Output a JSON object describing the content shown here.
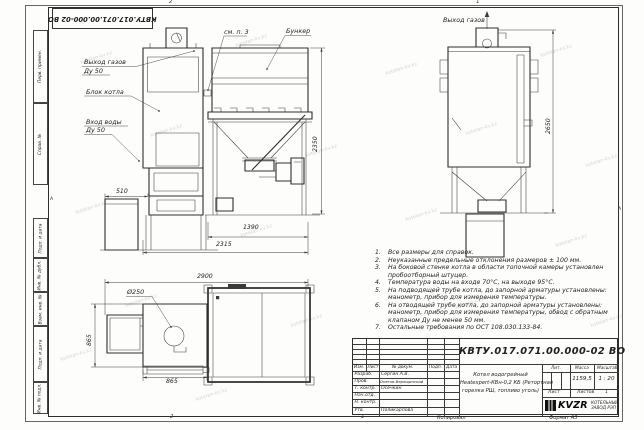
{
  "sheet": {
    "corner_ref": "КВТУ.017.071.00.000-02 ВО",
    "zones": {
      "top_left": "2",
      "top_right": "1",
      "bottom_left": "2",
      "bottom_right": "1"
    },
    "fold_mark": "А",
    "side_stamps": [
      "Перв. примен.",
      "Справ. №",
      "Подп. и дата",
      "Инв. № дубл.",
      "Взам. инв. №",
      "Подп. и дата",
      "Инв. № подл."
    ]
  },
  "watermark": {
    "text": "kotelan-kv.kz"
  },
  "callouts": {
    "gas_out_front_1": "Выход газов",
    "gas_out_front_2": "Ду 50",
    "boiler_block": "Блок котла",
    "water_in_1": "Вход воды",
    "water_in_2": "Ду 50",
    "see_note_3": "см. п. 3",
    "bunker": "Бункер",
    "gas_out_side": "Выход газов",
    "diameter": "Ø250"
  },
  "dimensions": {
    "ash_width": "510",
    "bunker_height": "2350",
    "bunker_width": "1390",
    "depth": "2315",
    "side_height": "2650",
    "plan_width": "2900",
    "plan_depth": "865",
    "boiler_width": "865"
  },
  "notes": {
    "items": [
      {
        "n": "1.",
        "text": "Все размеры для справок."
      },
      {
        "n": "2.",
        "text": "Неуказанные предельные отклонения размеров ± 100 мм."
      },
      {
        "n": "3.",
        "text": "На боковой стенке котла в области топочной камеры установлен пробоотборный штуцер."
      },
      {
        "n": "4.",
        "text": "Температура воды на входе 70°С, на выходе 95°С."
      },
      {
        "n": "5.",
        "text": "На подводящей трубе котла, до запорной арматуры установлены: манометр, прибор для измерения температуры."
      },
      {
        "n": "6.",
        "text": "На отводящей трубе котла, до запорной арматуры установлены: манометр, прибор для измерения температуры, обвод с обратным клапаном Ду не менее 50 мм."
      },
      {
        "n": "7.",
        "text": "Остальные требования по ОСТ 108.030.133-84."
      }
    ]
  },
  "title_block": {
    "doc_number": "КВТУ.017.071.00.000-02 ВО",
    "product": {
      "line1": "Котел водогрейный",
      "line2": "Heatexpert-КВн-0,2 КБ (Ретортная",
      "line3": "горелка РШ, топливо уголь)"
    },
    "columns": {
      "izm": "Изм.",
      "list": "Лист",
      "doc": "№ докум.",
      "podp": "Подп.",
      "data": "Дата"
    },
    "staff": [
      {
        "role": "Разраб.",
        "name": "Сергин А.В."
      },
      {
        "role": "Пров.",
        "name": "Онегов-Верещинский"
      },
      {
        "role": "Т. контр.",
        "name": "Осечкин"
      },
      {
        "role": "Нач.отд.",
        "name": ""
      },
      {
        "role": "Н. контр.",
        "name": ""
      },
      {
        "role": "Утв.",
        "name": "Поликарпова"
      }
    ],
    "lit_label": "Лит.",
    "mass_label": "Масса",
    "scale_label": "Масштаб",
    "mass_value": "1159,5",
    "scale_value": "1 : 20",
    "sheet_label": "Лист",
    "sheets_label": "Листов",
    "sheets_value": "1",
    "logo_text": "KVZR",
    "company_line1": "КОТЕЛЬНЫЙ",
    "company_line2": "ЗАВОД РЭП",
    "copied": "Копировал",
    "format": "Формат А3"
  }
}
